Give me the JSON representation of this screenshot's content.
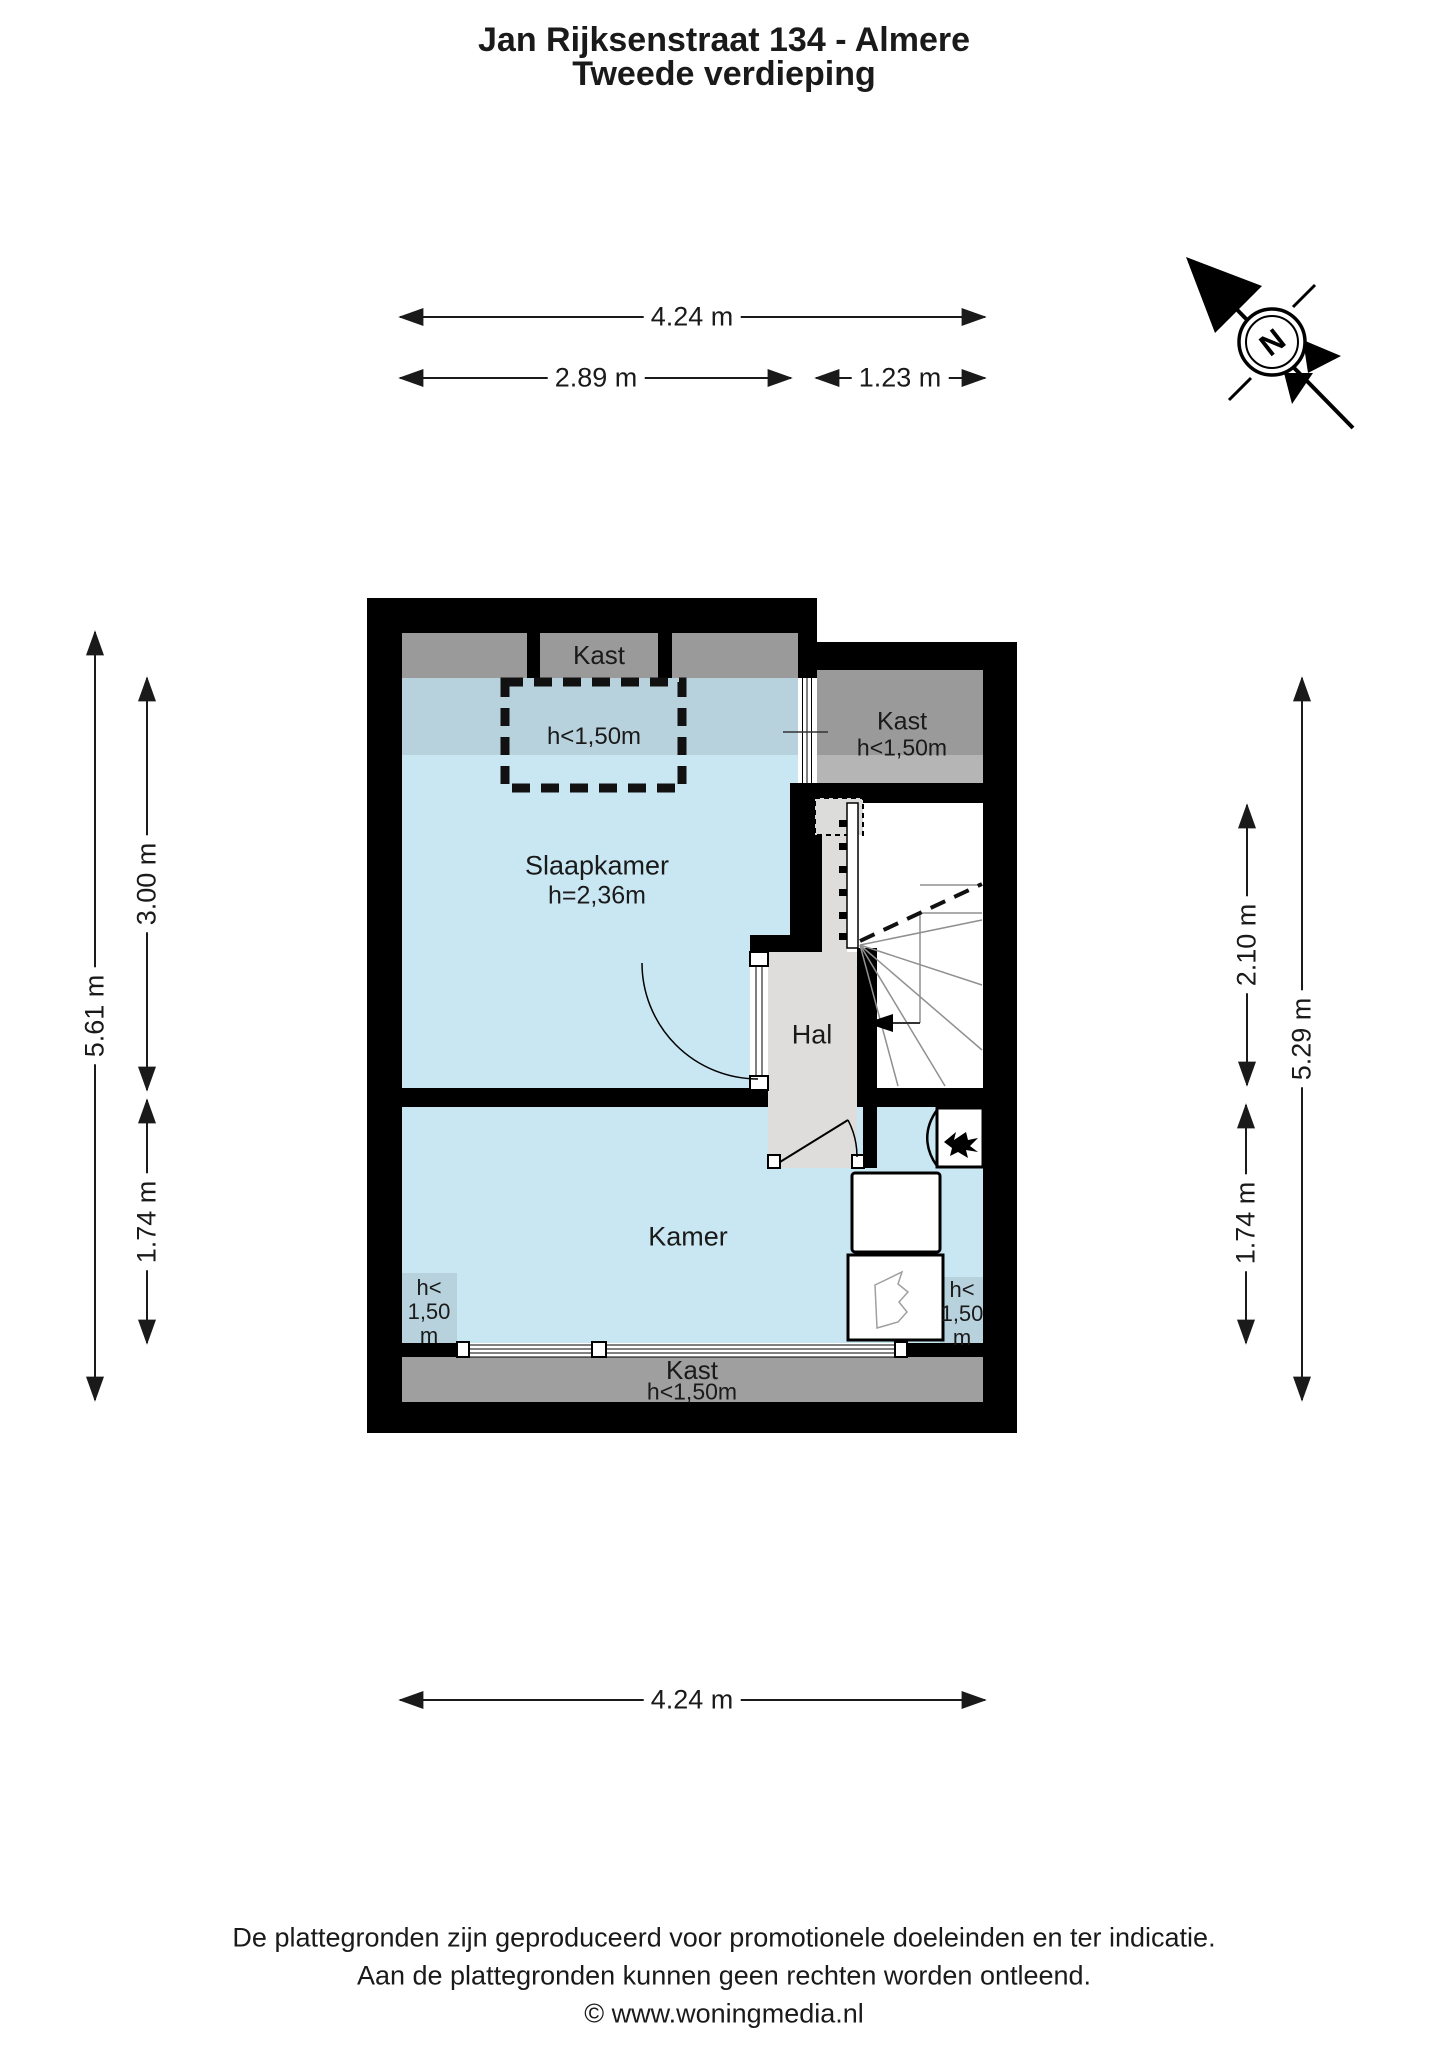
{
  "title": {
    "line1": "Jan Rijksenstraat 134 - Almere",
    "line2": "Tweede verdieping"
  },
  "compass": {
    "label": "N"
  },
  "dimensions": {
    "top_total": "4.24 m",
    "top_left": "2.89 m",
    "top_right": "1.23 m",
    "left_total": "5.61 m",
    "left_upper": "3.00 m",
    "left_lower": "1.74 m",
    "right_total": "5.29 m",
    "right_upper": "2.10 m",
    "right_lower": "1.74 m",
    "bottom_total": "4.24 m"
  },
  "rooms": {
    "kast_top": "Kast",
    "kast_right": {
      "name": "Kast",
      "height": "h<1,50m"
    },
    "slaapkamer": {
      "name": "Slaapkamer",
      "height": "h=2,36m"
    },
    "dormer_height": "h<1,50m",
    "hal": "Hal",
    "kamer": "Kamer",
    "kast_bottom": {
      "name": "Kast",
      "height": "h<1,50m"
    },
    "low_left": [
      "h<",
      "1,50",
      "m"
    ],
    "low_right": [
      "h<",
      "1,50",
      "m"
    ]
  },
  "footer": {
    "line1": "De plattegronden zijn geproduceerd voor promotionele doeleinden en ter indicatie.",
    "line2": "Aan de plattegronden kunnen geen rechten worden ontleend.",
    "line3": "© www.woningmedia.nl"
  },
  "colors": {
    "wall": "#000000",
    "floor_blue": "#c9e7f2",
    "floor_blue_low": "#b7d2dc",
    "closet_gray": "#9a9a9a",
    "closet_gray_light": "#b5b5b5",
    "closet_gray_bottom": "#9f9f9f",
    "hall_gray": "#dedddb",
    "text": "#1a1a1a"
  }
}
